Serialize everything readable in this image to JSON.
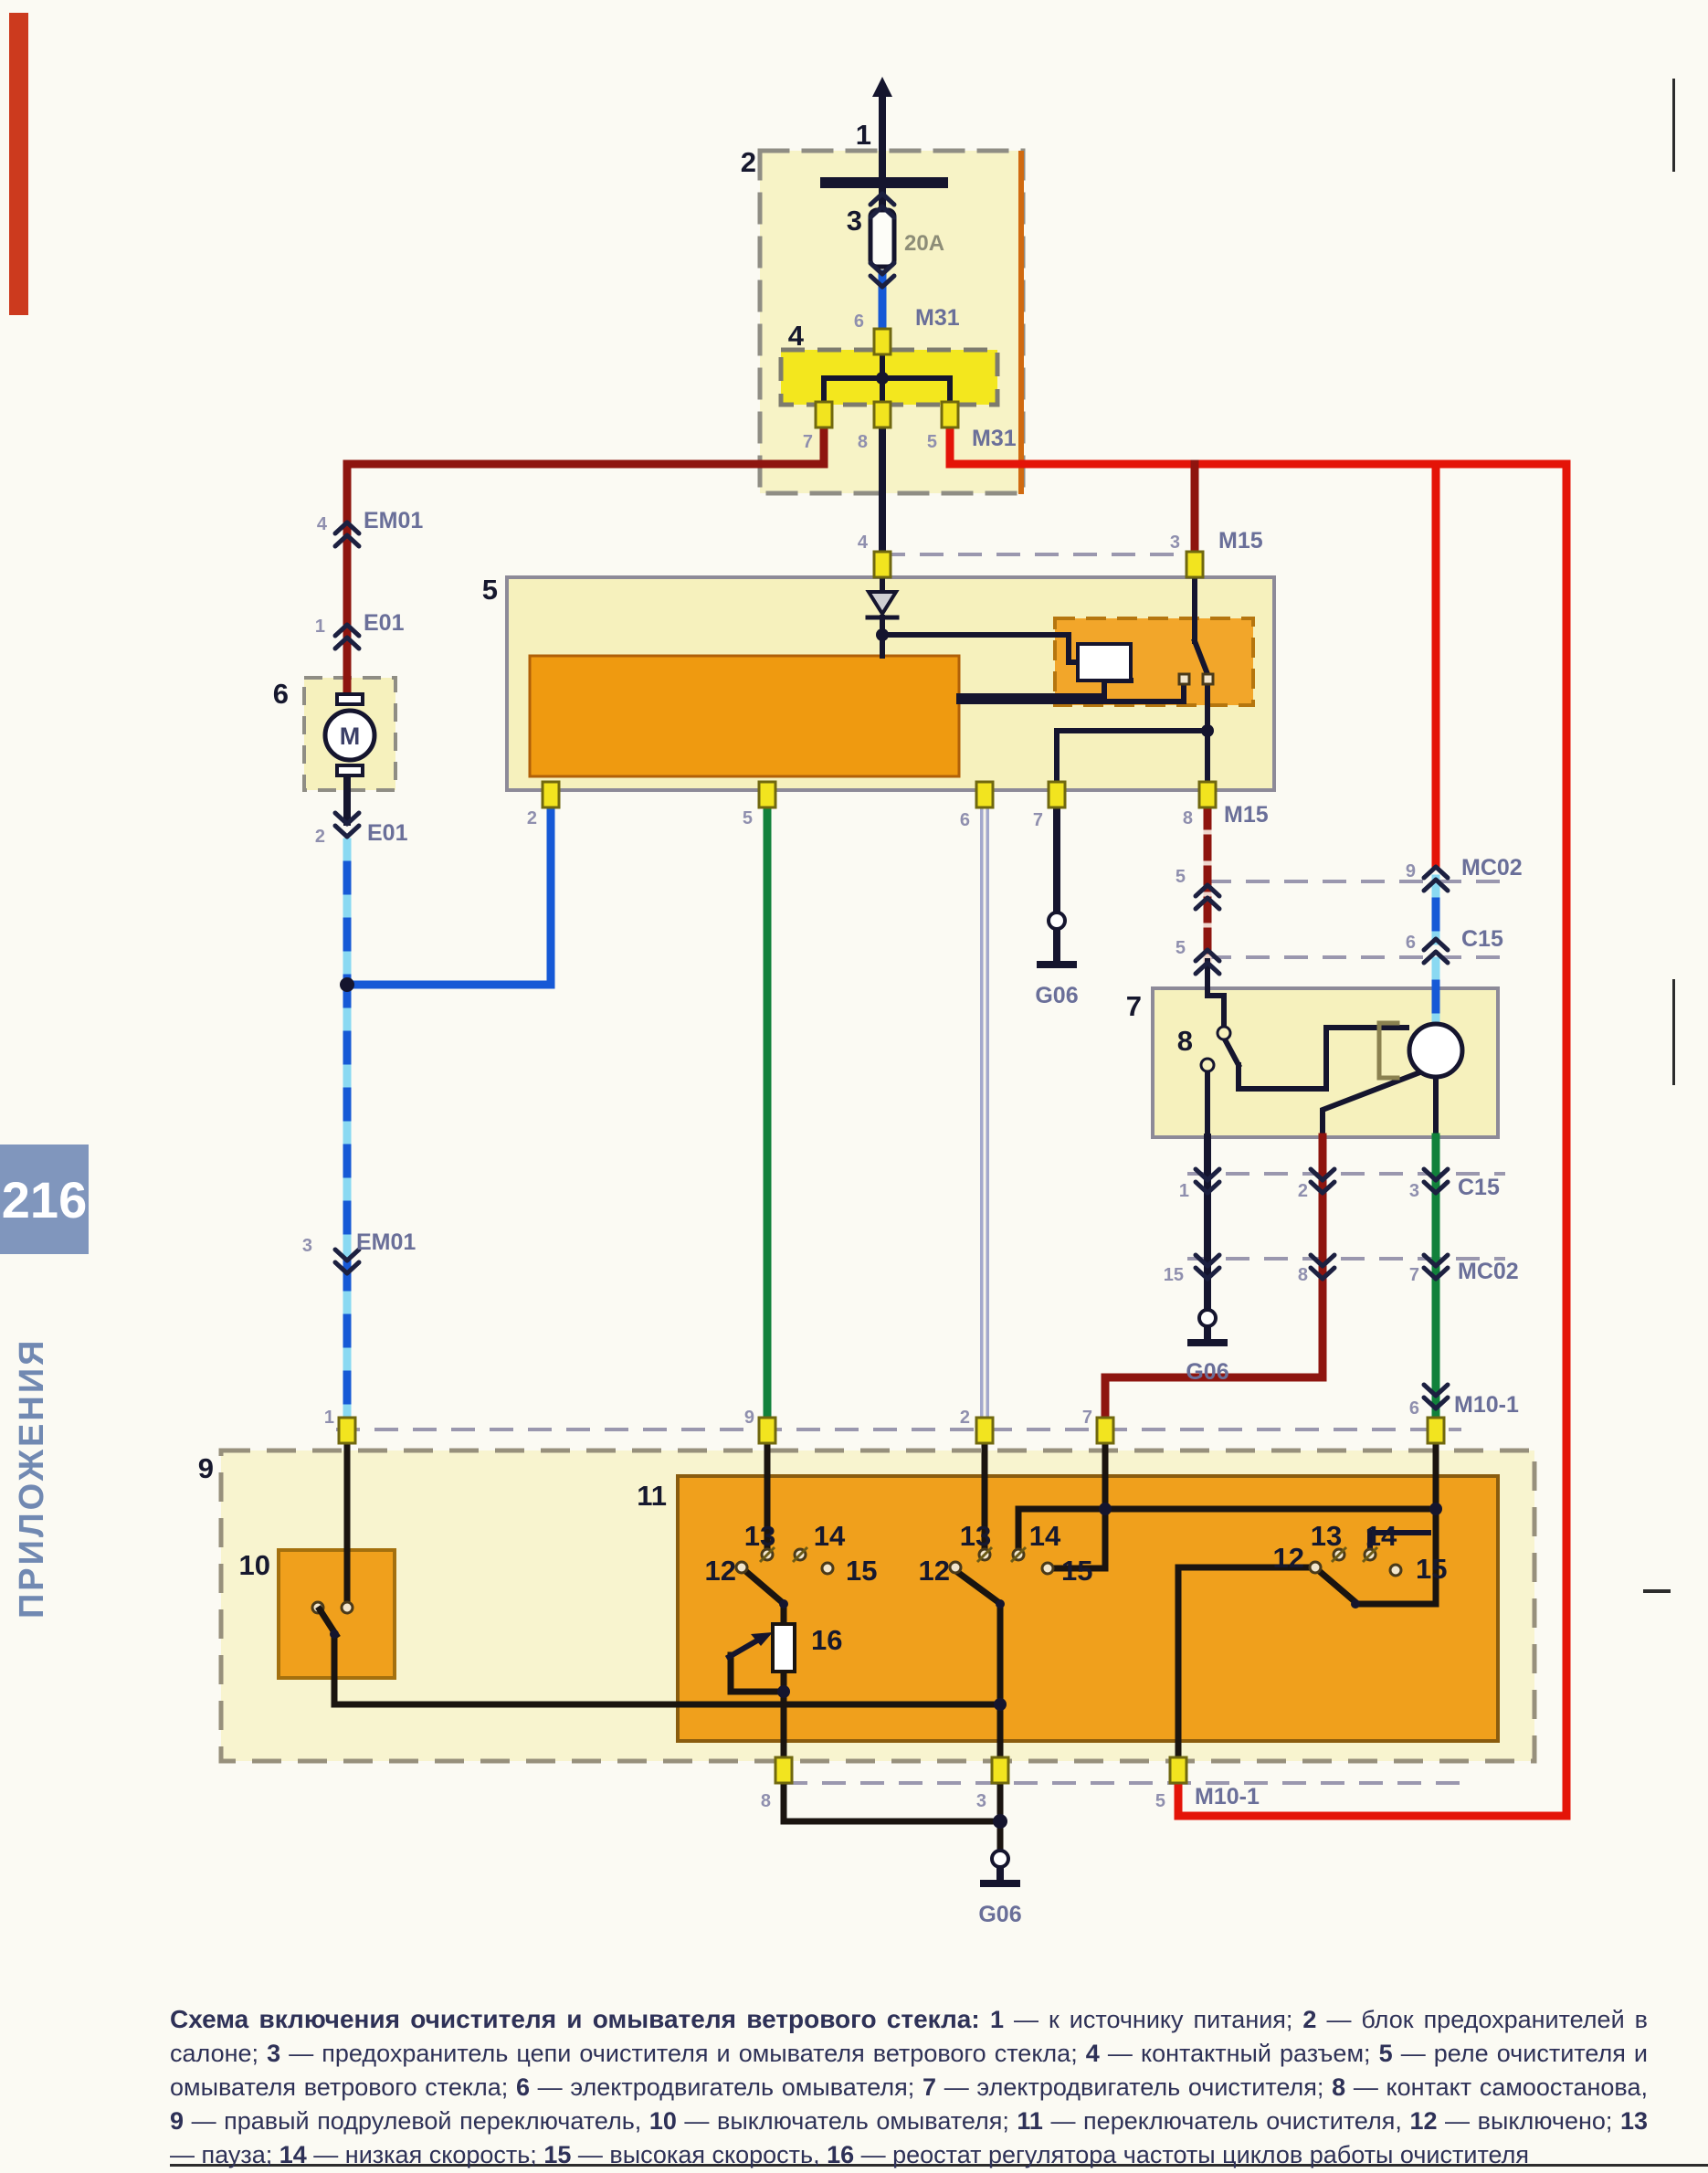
{
  "page": {
    "number": "216",
    "section_vertical": "ПРИЛОЖЕНИЯ"
  },
  "diagram": {
    "wire_colors": {
      "power_red": "#e41408",
      "dark_red": "#8e150f",
      "blue": "#1659d6",
      "blue_stripe": "#8ad9f2",
      "green": "#11813b",
      "lavender": "#a3a8cc",
      "black": "#15152e",
      "pin_yellow": "#f2e41f",
      "box_yellow": "#f6f1bd",
      "box_orange": "#f0a01c",
      "bright_yellow": "#f3e71e"
    },
    "labels": {
      "n1": "1",
      "n2": "2",
      "n3": "3",
      "n4": "4",
      "n5": "5",
      "n6": "6",
      "n7": "7",
      "n8": "8",
      "n9": "9",
      "n10": "10",
      "n11": "11",
      "n16": "16",
      "g1_12": "12",
      "g1_13": "13",
      "g1_14": "14",
      "g1_15": "15",
      "g2_12": "12",
      "g2_13": "13",
      "g2_14": "14",
      "g2_15": "15",
      "g3_12": "12",
      "g3_13": "13",
      "g3_14": "14",
      "g3_15": "15",
      "fuse_rating": "20A",
      "m31_top_pin": "6",
      "m31_top": "M31",
      "m31_p7": "7",
      "m31_p8": "8",
      "m31_p5": "5",
      "m31_right": "M31",
      "em01_u_pin": "4",
      "em01_u": "EM01",
      "e01_u_pin": "1",
      "e01_u": "E01",
      "e01_l_pin": "2",
      "e01_l": "E01",
      "em01_m_pin": "3",
      "em01_m": "EM01",
      "m15_t_pin4": "4",
      "m15_t_pin3": "3",
      "m15_t": "M15",
      "r5_p2": "2",
      "r5_p5": "5",
      "r5_p6": "6",
      "r5_p7": "7",
      "r5_p8": "8",
      "m15_b": "M15",
      "g06_1": "G06",
      "g06_2": "G06",
      "g06_3": "G06",
      "mc02_u_p5": "5",
      "mc02_u_p9": "9",
      "mc02_u": "MC02",
      "c15_u_p5": "5",
      "c15_u_p6": "6",
      "c15_u": "C15",
      "c15_l_p1": "1",
      "c15_l_p2": "2",
      "c15_l_p3": "3",
      "c15_l": "C15",
      "mc02_l_p15": "15",
      "mc02_l_p8": "8",
      "mc02_l_p7": "7",
      "mc02_l": "MC02",
      "m10_t_p6": "6",
      "m10_t": "M10-1",
      "b9_p1": "1",
      "b9_p9": "9",
      "b9_p2": "2",
      "b9_p7": "7",
      "b9_b_p8": "8",
      "b9_b_p3": "3",
      "b9_b_p5": "5",
      "m10_b": "M10-1",
      "motor_m": "M"
    }
  },
  "caption": {
    "intro": "Схема включения очистителя и омывателя ветрового стекла:",
    "items": [
      {
        "n": "1",
        "t": "к источнику питания",
        "sep": ";"
      },
      {
        "n": "2",
        "t": "блок предохранителей в салоне",
        "sep": ";"
      },
      {
        "n": "3",
        "t": "предохранитель цепи очистителя и омывателя ветрового стекла",
        "sep": ";"
      },
      {
        "n": "4",
        "t": "контактный разъем",
        "sep": ";"
      },
      {
        "n": "5",
        "t": "реле очистителя и омывателя ветрового стекла",
        "sep": ";"
      },
      {
        "n": "6",
        "t": "электродвигатель омывателя",
        "sep": ";"
      },
      {
        "n": "7",
        "t": "электродвигатель очистителя",
        "sep": ";"
      },
      {
        "n": "8",
        "t": "контакт самоостанова",
        "sep": ","
      },
      {
        "n": "9",
        "t": "правый подрулевой переключатель",
        "sep": ","
      },
      {
        "n": "10",
        "t": "выключатель омывателя",
        "sep": ";"
      },
      {
        "n": "11",
        "t": "переключатель очистителя",
        "sep": ","
      },
      {
        "n": "12",
        "t": "выключено",
        "sep": ";"
      },
      {
        "n": "13",
        "t": "пауза",
        "sep": ";"
      },
      {
        "n": "14",
        "t": "низкая скорость",
        "sep": ";"
      },
      {
        "n": "15",
        "t": "высокая скорость",
        "sep": ","
      },
      {
        "n": "16",
        "t": "реостат регулятора частоты циклов работы очистителя",
        "sep": ""
      }
    ]
  }
}
